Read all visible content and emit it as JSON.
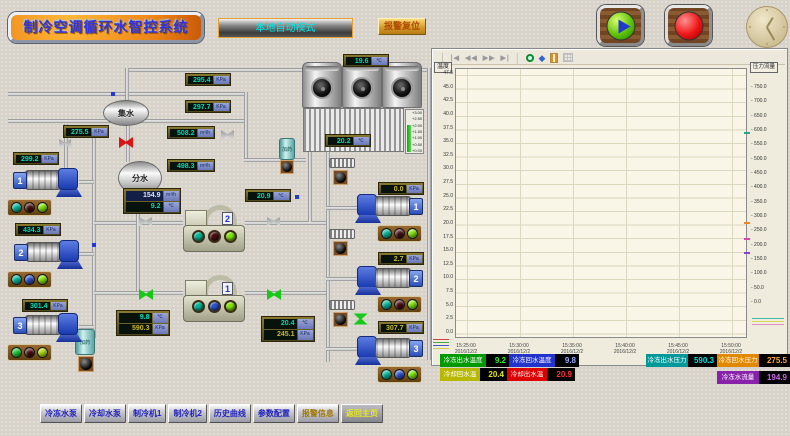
{
  "header": {
    "title": "制冷空调循环水智控系统",
    "mode_button": "本地自动模式",
    "alarm_reset_button": "报警复位"
  },
  "diagram": {
    "collector_tank_label": "集水",
    "distributor_tank_label": "分水",
    "dosing_tank_label": "加药",
    "tower_level_scale": [
      "+3.00",
      "+2.50",
      "+2.00",
      "+1.50",
      "+1.00",
      "+0.50",
      "+0.00"
    ],
    "gauges": {
      "tower_out_temp": {
        "value": "19.6",
        "unit": "℃"
      },
      "basin_temp": {
        "value": "20.2",
        "unit": "℃"
      },
      "cooling_supply_pressure": {
        "value": "295.4",
        "unit": "KPa"
      },
      "cooling_return_pressure": {
        "value": "297.7",
        "unit": "KPa"
      },
      "cooling_supply_flow": {
        "value": "508.2",
        "unit": "m³/h"
      },
      "cooling_return_flow": {
        "value": "498.3",
        "unit": "m³/h"
      },
      "chilled_return_pressure": {
        "value": "275.5",
        "unit": "KPa"
      },
      "pump1_pressure": {
        "value": "299.2",
        "unit": "KPa"
      },
      "pump2_pressure": {
        "value": "434.3",
        "unit": "KPa"
      },
      "pump3_pressure": {
        "value": "301.4",
        "unit": "KPa"
      },
      "chilled_flow": {
        "value": "154.9",
        "unit": "m³/h"
      },
      "chilled_out_temp": {
        "value": "9.2",
        "unit": "℃"
      },
      "cooling_out_temp": {
        "value": "20.9",
        "unit": "℃"
      },
      "chilled_return_temp": {
        "value": "9.8",
        "unit": "℃"
      },
      "chilled_supply_pressure": {
        "value": "590.3",
        "unit": "KPa"
      },
      "cooling_return_temp": {
        "value": "20.4",
        "unit": "℃"
      },
      "cooling_pressure": {
        "value": "245.1",
        "unit": "KPa"
      },
      "rpump1_pressure": {
        "value": "0.0",
        "unit": "KPa"
      },
      "rpump2_pressure": {
        "value": "2.7",
        "unit": "KPa"
      },
      "rpump3_pressure": {
        "value": "307.7",
        "unit": "KPa"
      }
    },
    "pumps_left": [
      {
        "id": "1",
        "lights": [
          "#00b89a",
          "#4a0d10",
          "#7ee800"
        ]
      },
      {
        "id": "2",
        "lights": [
          "#00b89a",
          "#2a52d0",
          "#7ee800"
        ]
      },
      {
        "id": "3",
        "lights": [
          "#19cc33",
          "#4a0d10",
          "#aadd00"
        ]
      }
    ],
    "pumps_right": [
      {
        "id": "1",
        "lights": [
          "#00b89a",
          "#4a0d10",
          "#7ee800"
        ]
      },
      {
        "id": "2",
        "lights": [
          "#00b89a",
          "#4a0d10",
          "#7ee800"
        ]
      },
      {
        "id": "3",
        "lights": [
          "#00b89a",
          "#2a52d0",
          "#7ee800"
        ]
      }
    ],
    "chillers": [
      {
        "id": "2",
        "lights": [
          "#00b89a",
          "#4a0d10",
          "#7ee800"
        ]
      },
      {
        "id": "1",
        "lights": [
          "#00b89a",
          "#2a52d0",
          "#7ee800"
        ]
      }
    ]
  },
  "chart": {
    "toolbar_icons": [
      "|◀",
      "◀◀",
      "▶▶",
      "▶|"
    ],
    "left_axis_label": "温度",
    "right_axis_label": "压力流量",
    "left_ticks": [
      "47.5",
      "45.0",
      "42.5",
      "40.0",
      "37.5",
      "35.0",
      "32.5",
      "30.0",
      "27.5",
      "25.0",
      "22.5",
      "20.0",
      "17.5",
      "15.0",
      "12.5",
      "10.0",
      "7.5",
      "5.0",
      "2.5",
      "0.0"
    ],
    "right_ticks": [
      "750.0",
      "700.0",
      "650.0",
      "600.0",
      "550.0",
      "500.0",
      "450.0",
      "400.0",
      "350.0",
      "300.0",
      "250.0",
      "200.0",
      "150.0",
      "100.0",
      "50.0",
      "0.0"
    ],
    "time_labels": [
      {
        "time": "15:25:00",
        "date": "2016/12/2"
      },
      {
        "time": "15:30:00",
        "date": "2016/12/2"
      },
      {
        "time": "15:35:00",
        "date": "2016/12/2"
      },
      {
        "time": "15:40:00",
        "date": "2016/12/2"
      },
      {
        "time": "15:45:00",
        "date": "2016/12/2"
      },
      {
        "time": "15:50:00",
        "date": "2016/12/2"
      }
    ]
  },
  "readouts": [
    {
      "label": "冷冻出水温度",
      "value": "9.2",
      "color": "#009a00",
      "text": "#33ee33"
    },
    {
      "label": "冷冻回水温度",
      "value": "9.8",
      "color": "#2233cc",
      "text": "#99aaff"
    },
    {
      "label": "冷却回水温",
      "value": "20.4",
      "color": "#b8b800",
      "text": "#e8e800"
    },
    {
      "label": "冷却出水温",
      "value": "20.9",
      "color": "#dd0000",
      "text": "#ff3333"
    },
    {
      "label": "冷冻出水压力",
      "value": "590.3",
      "color": "#009898",
      "text": "#00e0e0"
    },
    {
      "label": "冷冻回水压力",
      "value": "275.5",
      "color": "#e08800",
      "text": "#ffaa33"
    },
    {
      "label": "冷冻水流量",
      "value": "194.9",
      "color": "#8822aa",
      "text": "#cc66ee"
    }
  ],
  "nav_buttons": [
    "冷冻水泵",
    "冷却水泵",
    "制冷机1",
    "制冷机2",
    "历史曲线",
    "参数配置",
    "报警信息",
    "返回主页"
  ]
}
